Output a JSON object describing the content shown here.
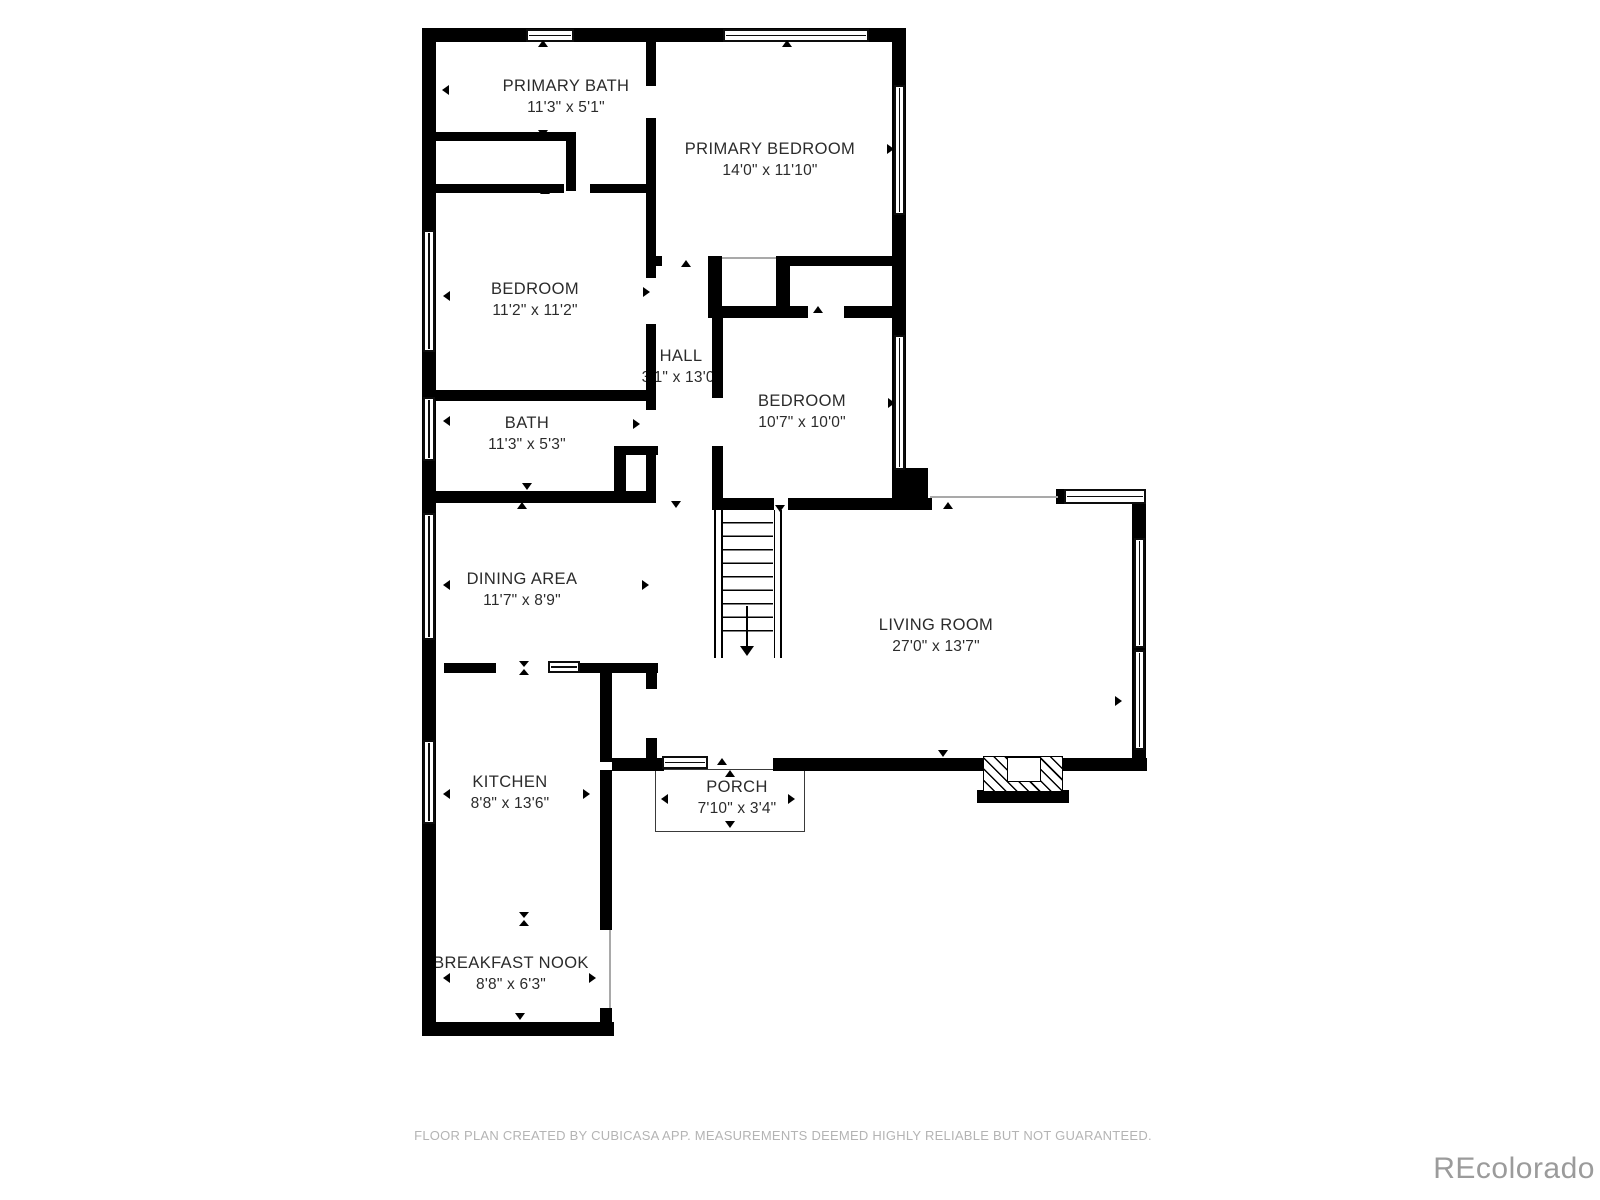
{
  "colors": {
    "wall": "#000000",
    "label": "#2b2b2b",
    "footer": "#b4b4b4",
    "watermark": "#9b9b9b"
  },
  "rooms": [
    {
      "key": "primary-bath",
      "name": "PRIMARY BATH",
      "dims": "11'3\" x 5'1\""
    },
    {
      "key": "primary-bedroom",
      "name": "PRIMARY BEDROOM",
      "dims": "14'0\" x 11'10\""
    },
    {
      "key": "bedroom-1",
      "name": "BEDROOM",
      "dims": "11'2\" x 11'2\""
    },
    {
      "key": "hall",
      "name": "HALL",
      "dims": "3'1\" x 13'0\""
    },
    {
      "key": "bedroom-2",
      "name": "BEDROOM",
      "dims": "10'7\" x 10'0\""
    },
    {
      "key": "bath",
      "name": "BATH",
      "dims": "11'3\" x 5'3\""
    },
    {
      "key": "dining-area",
      "name": "DINING AREA",
      "dims": "11'7\" x 8'9\""
    },
    {
      "key": "living-room",
      "name": "LIVING ROOM",
      "dims": "27'0\" x 13'7\""
    },
    {
      "key": "kitchen",
      "name": "KITCHEN",
      "dims": "8'8\" x 13'6\""
    },
    {
      "key": "porch",
      "name": "PORCH",
      "dims": "7'10\" x 3'4\""
    },
    {
      "key": "breakfast-nook",
      "name": "BREAKFAST NOOK",
      "dims": "8'8\" x 6'3\""
    }
  ],
  "footer": {
    "text": "FLOOR PLAN CREATED BY CUBICASA APP. MEASUREMENTS DEEMED HIGHLY RELIABLE BUT NOT GUARANTEED."
  },
  "watermark": {
    "text": "REcolorado"
  }
}
